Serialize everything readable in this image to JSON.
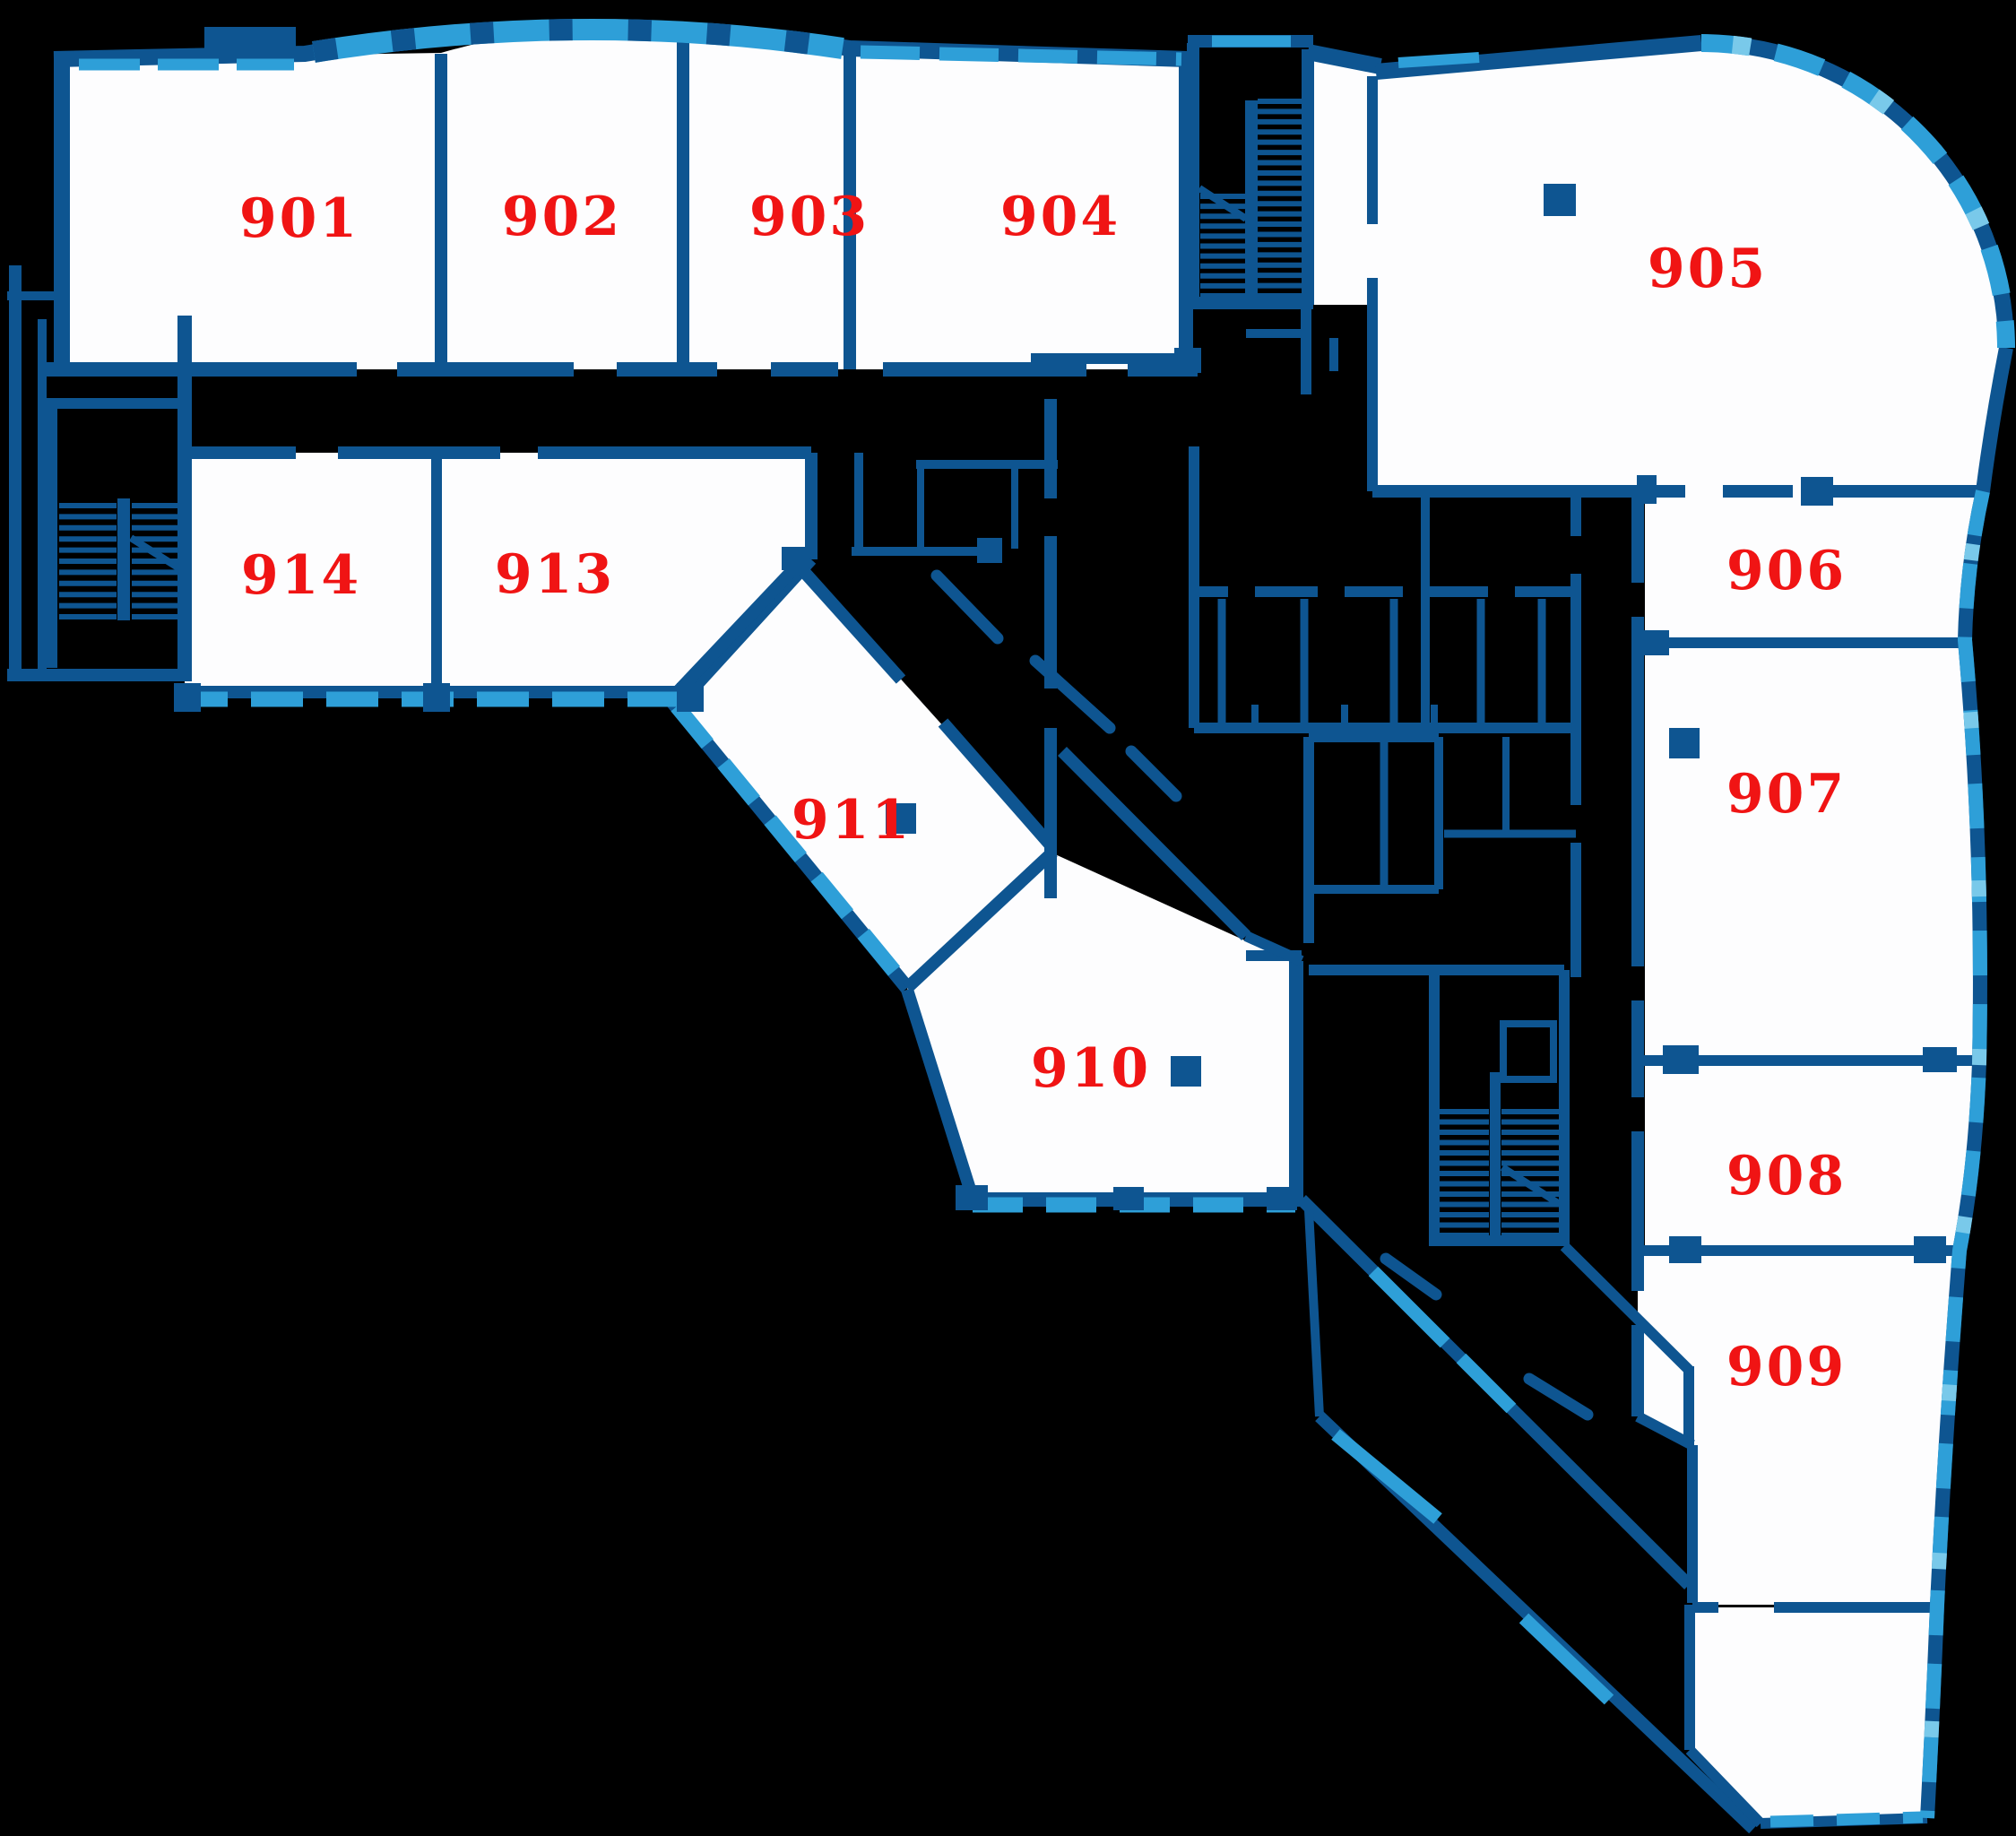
{
  "figure": {
    "type": "architectural-floor-plan",
    "floor_series": "9th floor (rooms 901-914)"
  },
  "colors": {
    "background": "#000000",
    "wall": "#0E5591",
    "window": "#2E9FD8",
    "window_light": "#79C9EA",
    "label": "#F01414",
    "floor": "#FDFDFE"
  },
  "rooms": [
    {
      "number": "901"
    },
    {
      "number": "902"
    },
    {
      "number": "903"
    },
    {
      "number": "904"
    },
    {
      "number": "905"
    },
    {
      "number": "906"
    },
    {
      "number": "907"
    },
    {
      "number": "908"
    },
    {
      "number": "909"
    },
    {
      "number": "910"
    },
    {
      "number": "911"
    },
    {
      "number": "913"
    },
    {
      "number": "914"
    }
  ],
  "stairwells": [
    {
      "name": "north-stairwell"
    },
    {
      "name": "west-stairwell"
    },
    {
      "name": "south-stairwell"
    }
  ]
}
